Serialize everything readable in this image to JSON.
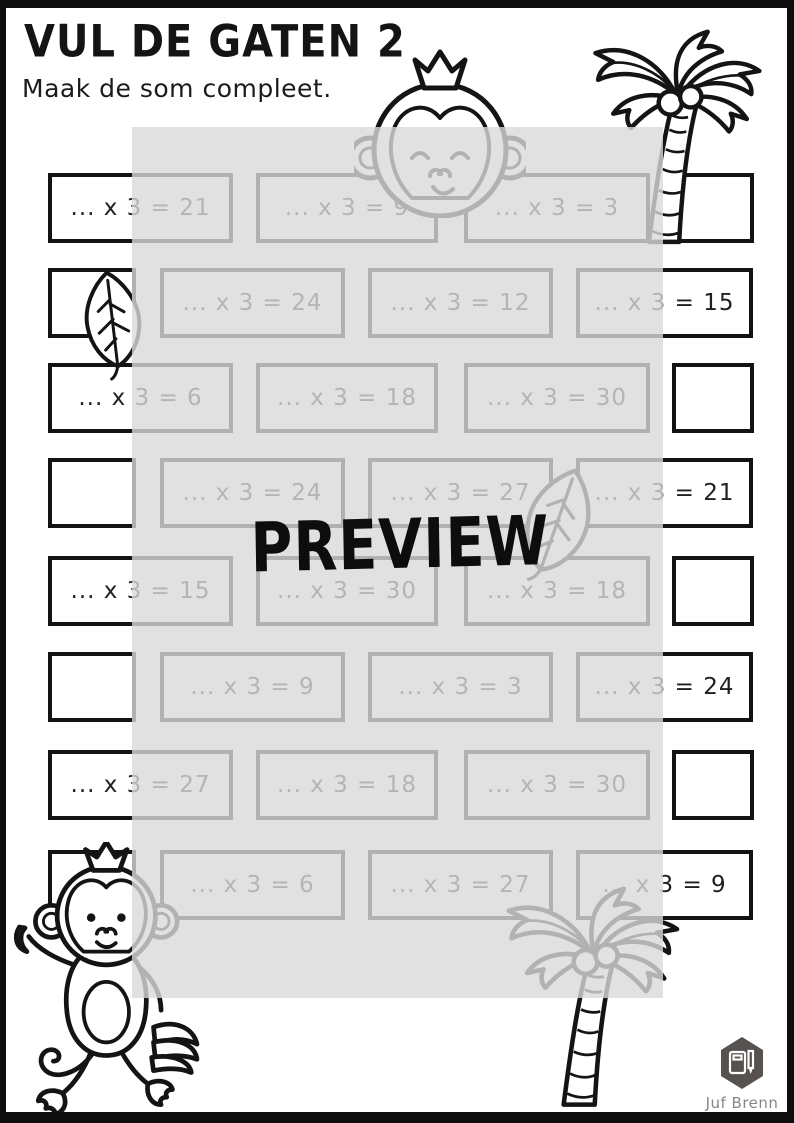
{
  "page": {
    "title": "VUL DE GATEN 2",
    "subtitle": "Maak de som compleet.",
    "watermark": "PREVIEW",
    "brand": {
      "name": "Juf Brenn"
    }
  },
  "colors": {
    "ink": "#131313",
    "overlay_gray": "#d9d9d9",
    "brand_hexagon": "#575150",
    "brand_text": "#8b8683"
  },
  "decorations": [
    "monkey-face",
    "palm-tree-top-right",
    "leaf-left",
    "leaf-middle",
    "monkey-bottom-left",
    "palm-tree-bottom-right"
  ],
  "grid": {
    "rows": [
      {
        "cells": [
          {
            "type": "problem",
            "text": "... x 3 = 21"
          },
          {
            "type": "problem",
            "text": "... x 3 = 9"
          },
          {
            "type": "problem",
            "text": "... x 3 = 3"
          },
          {
            "type": "empty"
          }
        ]
      },
      {
        "cells": [
          {
            "type": "empty"
          },
          {
            "type": "problem",
            "text": "... x 3 = 24"
          },
          {
            "type": "problem",
            "text": "... x 3 = 12"
          },
          {
            "type": "problem",
            "text": "... x 3 = 15"
          }
        ]
      },
      {
        "cells": [
          {
            "type": "problem",
            "text": "... x 3 = 6"
          },
          {
            "type": "problem",
            "text": "... x 3 = 18"
          },
          {
            "type": "problem",
            "text": "... x 3 = 30"
          },
          {
            "type": "empty"
          }
        ]
      },
      {
        "cells": [
          {
            "type": "empty"
          },
          {
            "type": "problem",
            "text": "... x 3 = 24"
          },
          {
            "type": "problem",
            "text": "... x 3 = 27"
          },
          {
            "type": "problem",
            "text": "... x 3 = 21"
          }
        ]
      },
      {
        "cells": [
          {
            "type": "problem",
            "text": "... x 3 = 15"
          },
          {
            "type": "problem",
            "text": "... x 3 = 30"
          },
          {
            "type": "problem",
            "text": "... x 3 = 18"
          },
          {
            "type": "empty"
          }
        ]
      },
      {
        "cells": [
          {
            "type": "empty"
          },
          {
            "type": "problem",
            "text": "... x 3 = 9"
          },
          {
            "type": "problem",
            "text": "... x 3 = 3"
          },
          {
            "type": "problem",
            "text": "... x 3 = 24"
          }
        ]
      },
      {
        "cells": [
          {
            "type": "problem",
            "text": "... x 3 = 27"
          },
          {
            "type": "problem",
            "text": "... x 3 = 18"
          },
          {
            "type": "problem",
            "text": "... x 3 = 30"
          },
          {
            "type": "empty"
          }
        ]
      },
      {
        "cells": [
          {
            "type": "empty"
          },
          {
            "type": "problem",
            "text": "... x 3 = 6"
          },
          {
            "type": "problem",
            "text": "... x 3 = 27"
          },
          {
            "type": "problem",
            "text": "... x 3 = 9"
          }
        ]
      }
    ]
  }
}
